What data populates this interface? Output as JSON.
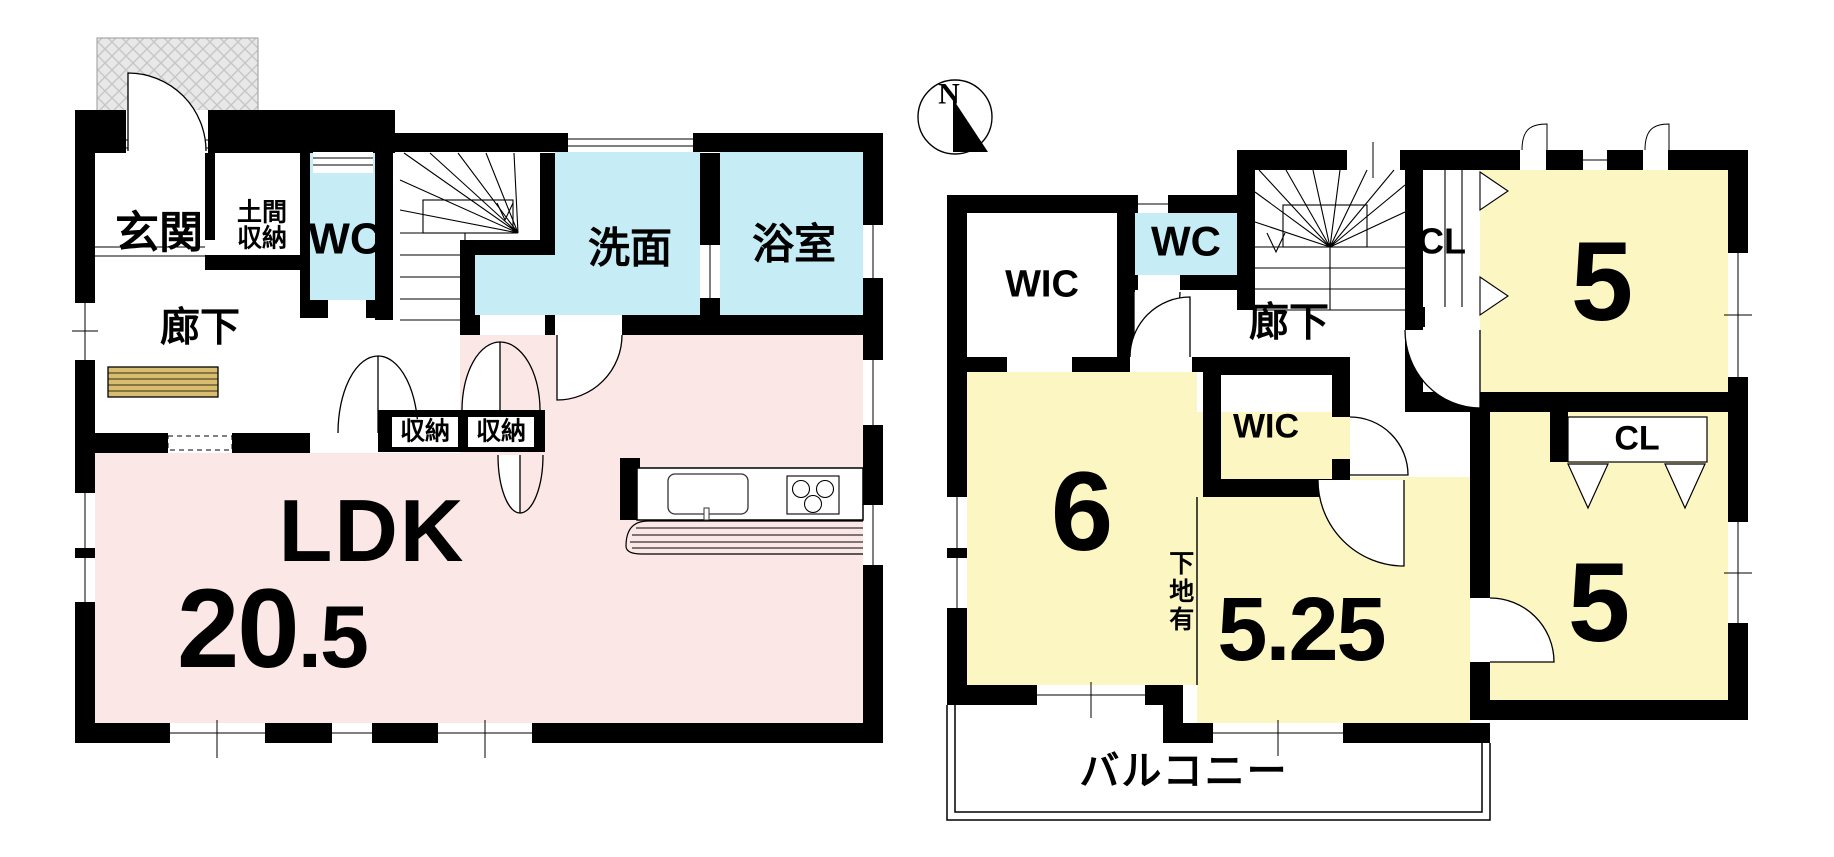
{
  "floor1": {
    "entrance": "玄関",
    "doma_storage": "土間\n収納",
    "wc": "WC",
    "washroom": "洗面",
    "bathroom": "浴室",
    "corridor": "廊下",
    "storage_a": "収納",
    "storage_b": "収納",
    "ldk_label": "LDK",
    "ldk_size_main": "20",
    "ldk_size_decimal": ".5"
  },
  "floor2": {
    "compass_north": "N",
    "wic_upper": "WIC",
    "wc": "WC",
    "corridor": "廊下",
    "closet_upper": "CL",
    "room_ne_size": "5",
    "wic_center": "WIC",
    "room_west_size": "6",
    "wall_note": "下地有",
    "room_south_size": "5.25",
    "room_se_size": "5",
    "closet_se": "CL",
    "balcony": "バルコニー"
  },
  "colors": {
    "ldk_pink": "#fbe7e6",
    "wet_area_cyan": "#c6edf5",
    "bedroom_yellow": "#fcf6c2",
    "cabinet_tan": "#d8bd6e",
    "wall_black": "#000000",
    "porch_hatch_gray": "#e8e8e8"
  }
}
